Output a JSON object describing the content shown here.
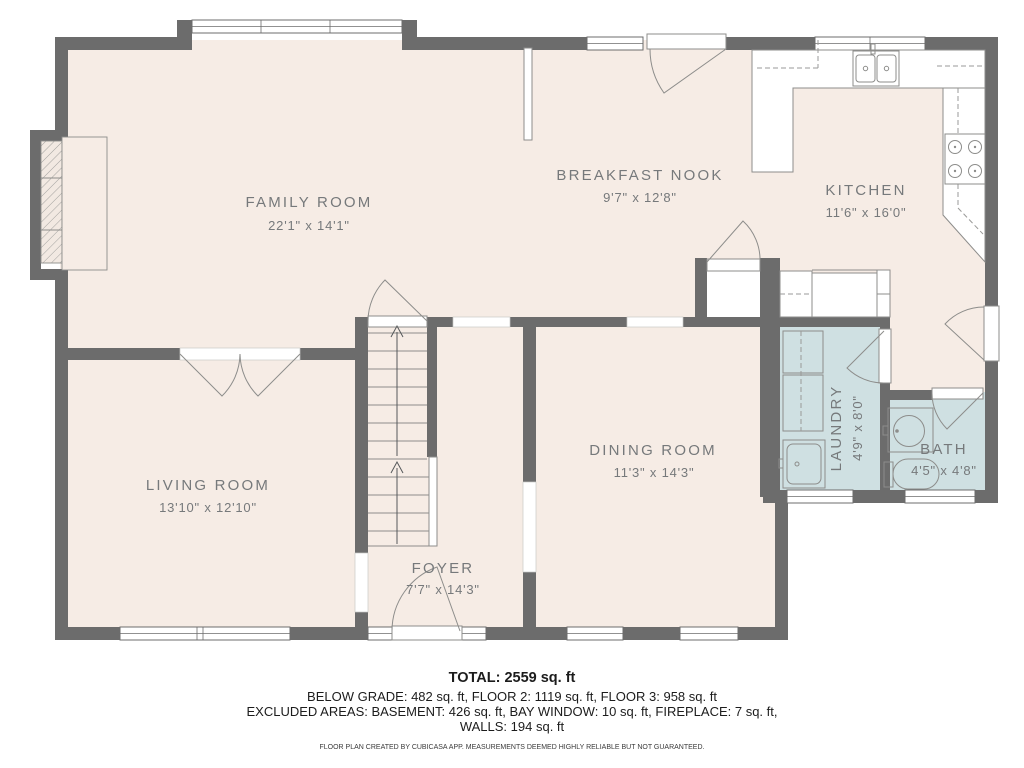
{
  "plan": {
    "rooms": [
      {
        "name": "FAMILY ROOM",
        "dims": "22'1\" x 14'1\""
      },
      {
        "name": "BREAKFAST NOOK",
        "dims": "9'7\" x 12'8\""
      },
      {
        "name": "KITCHEN",
        "dims": "11'6\" x 16'0\""
      },
      {
        "name": "LIVING ROOM",
        "dims": "13'10\" x 12'10\""
      },
      {
        "name": "DINING ROOM",
        "dims": "11'3\" x 14'3\""
      },
      {
        "name": "FOYER",
        "dims": "7'7\" x 14'3\""
      },
      {
        "name": "LAUNDRY",
        "dims": "4'9\" x 8'0\""
      },
      {
        "name": "BATH",
        "dims": "4'5\" x 4'8\""
      }
    ],
    "footer": {
      "total": "TOTAL: 2559 sq. ft",
      "line2": "BELOW GRADE: 482 sq. ft, FLOOR 2: 1119 sq. ft, FLOOR 3: 958 sq. ft",
      "line3": "EXCLUDED AREAS: BASEMENT: 426 sq. ft, BAY WINDOW: 10 sq. ft, FIREPLACE: 7 sq. ft,",
      "line4": "WALLS: 194 sq. ft",
      "disclaimer": "FLOOR PLAN CREATED BY CUBICASA APP. MEASUREMENTS DEEMED HIGHLY RELIABLE BUT NOT GUARANTEED."
    },
    "colors": {
      "wall": "#6c6c6c",
      "floor": "#f6ece5",
      "wet_room_floor": "#cfe0e2",
      "label_text": "#76797b",
      "fixture_line": "#8d8d8b",
      "footer_text": "#1c1c1c"
    }
  }
}
